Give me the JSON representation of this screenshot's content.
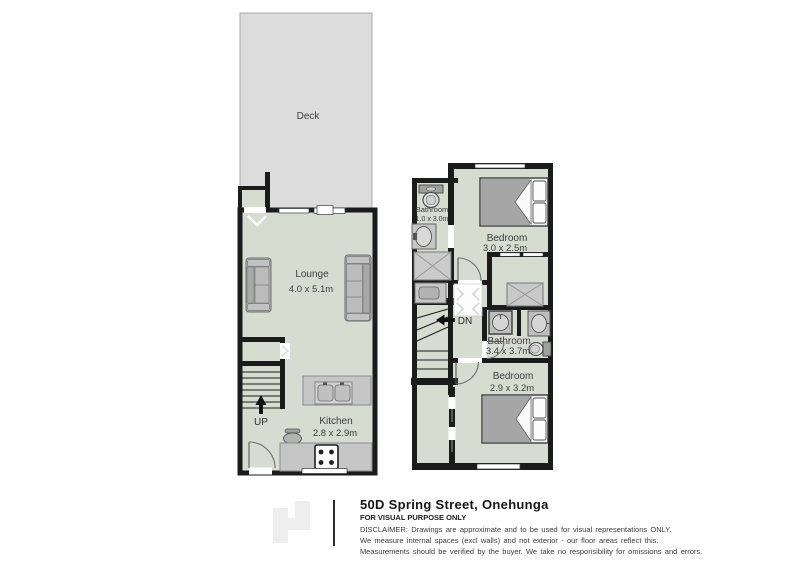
{
  "colors": {
    "floor": "#d6dcd0",
    "wall": "#1b1b1b",
    "deck_fill": "#dcdcdc",
    "furniture_gray": "#c6c6c6"
  },
  "ground_floor": {
    "deck_label": "Deck",
    "lounge_label": "Lounge",
    "lounge_dims": "4.0 x 5.1m",
    "kitchen_label": "Kitchen",
    "kitchen_dims": "2.8 x 2.9m",
    "stairs_label": "UP"
  },
  "upper_floor": {
    "ensuite_label": "Bathroom",
    "ensuite_dims": "1.0 x 3.0m",
    "bedroom1_label": "Bedroom",
    "bedroom1_dims": "3.0 x 2.5m",
    "stairs_label": "DN",
    "bathroom_label": "Bathroom",
    "bathroom_dims": "3.4 x 3.7m",
    "bedroom2_label": "Bedroom",
    "bedroom2_dims": "2.9 x 3.2m"
  },
  "footer": {
    "address": "50D Spring Street, Onehunga",
    "purpose": "FOR VISUAL PURPOSE ONLY",
    "disclaimer": [
      "DISCLAIMER:  Drawings are approximate and to be used for visual representations ONLY.",
      "We measure internal spaces (excl walls) and not exterior - our floor areas reflect this.",
      "Measurements should be verified by the buyer. We take no responsibility for omissions and errors."
    ]
  }
}
